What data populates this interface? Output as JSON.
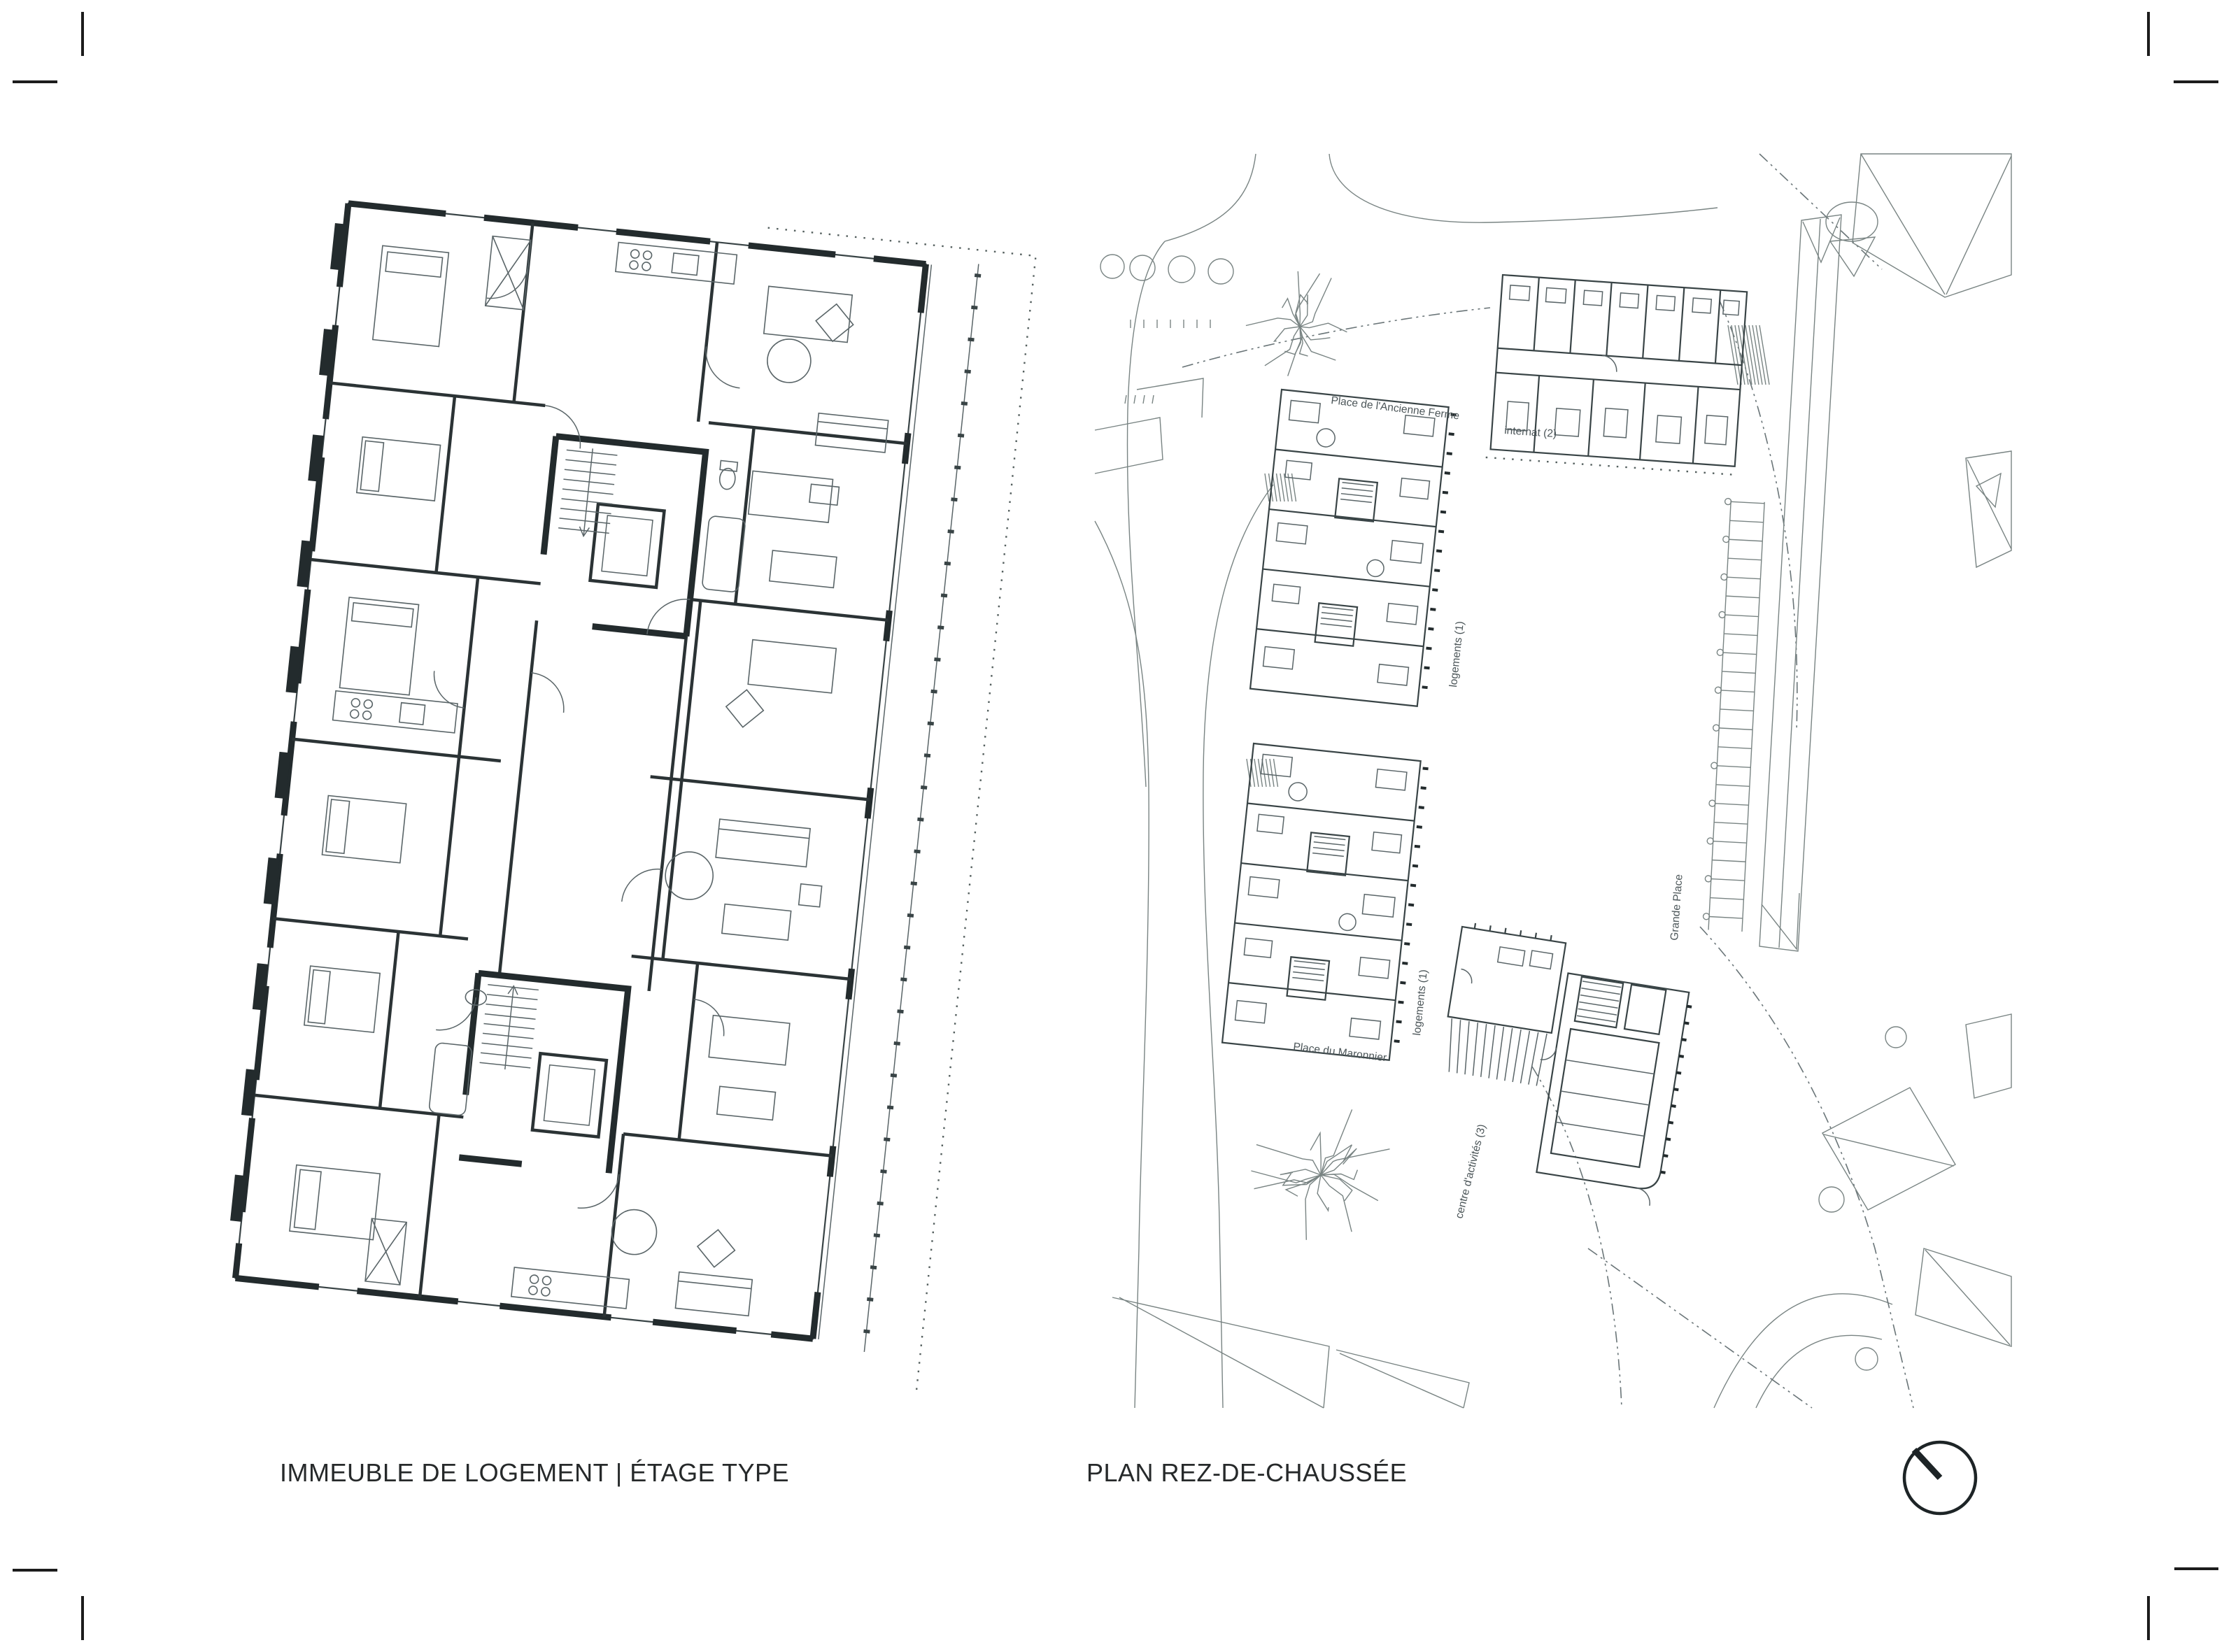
{
  "page": {
    "background": "#ffffff",
    "ink_color": "#232b2d",
    "light_ink_color": "#6a7578"
  },
  "figures": {
    "floor_plan": {
      "caption": "IMMEUBLE DE LOGEMENT | ÉTAGE TYPE"
    },
    "site_plan": {
      "caption": "PLAN REZ-DE-CHAUSSÉE",
      "labels": {
        "place_ancienne_ferme": "Place de l'Ancienne Ferme",
        "internat": "internat (2)",
        "logements_upper": "logements (1)",
        "logements_lower": "logements (1)",
        "place_maronnier": "Place du Maronnier",
        "grande_place": "Grande Place",
        "centre_activites": "centre d'activités (3)"
      }
    }
  },
  "icons": {
    "north_arrow": "north-arrow-icon"
  }
}
